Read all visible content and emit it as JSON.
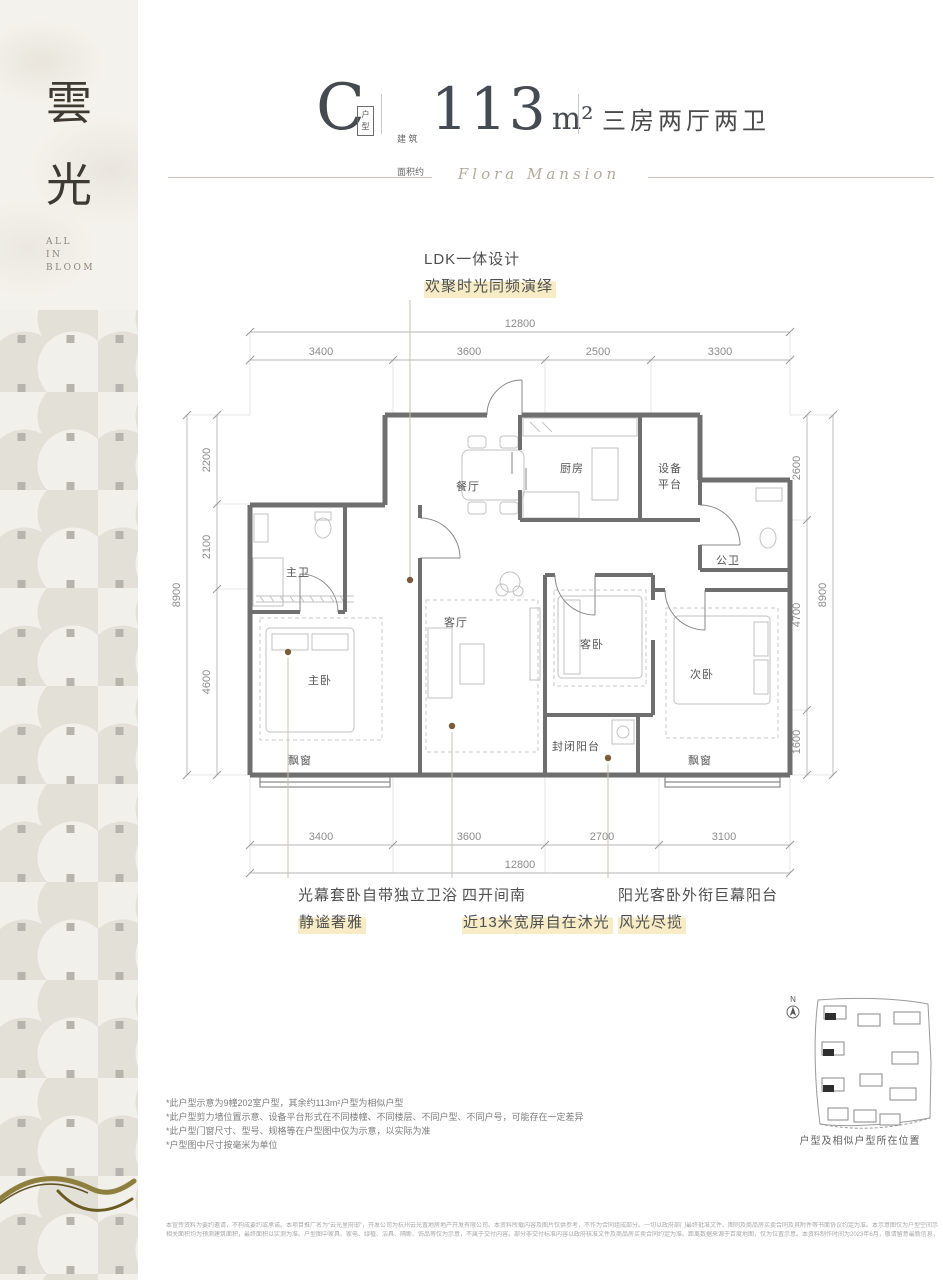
{
  "sidebar": {
    "char1": "雲",
    "char2": "光",
    "tagline1": "ALL",
    "tagline2": "IN",
    "tagline3": "BLOOM"
  },
  "header": {
    "unit_letter": "C",
    "unit_badge": "户型",
    "area_prefix_line1": "建 筑",
    "area_prefix_line2": "面积约",
    "area_value": "113",
    "area_unit": "m²",
    "rooms_label": "三房两厅两卫",
    "script_title": "Flora Mansion"
  },
  "callout_top": {
    "line1": "LDK一体设计",
    "line2": "欢聚时光同频演绎"
  },
  "callouts_bottom": [
    {
      "line1": "光幕套卧自带独立卫浴",
      "line2": "静谧奢雅"
    },
    {
      "line1": "四开间南",
      "line2": "近13米宽屏自在沐光"
    },
    {
      "line1": "阳光客卧外衔巨幕阳台",
      "line2": "风光尽揽"
    }
  ],
  "floorplan": {
    "rooms": {
      "dining": "餐厅",
      "kitchen": "厨房",
      "equip_line1": "设备",
      "equip_line2": "平台",
      "master_bath": "主卫",
      "public_bath": "公卫",
      "master_bed": "主卧",
      "living": "客厅",
      "guest_bed": "客卧",
      "second_bed": "次卧",
      "balcony": "封闭阳台",
      "bay_window": "飘窗"
    },
    "dims": {
      "top_total": "12800",
      "top_s1": "3400",
      "top_s2": "3600",
      "top_s3": "2500",
      "top_s4": "3300",
      "bottom_s1": "3400",
      "bottom_s2": "3600",
      "bottom_s3": "2700",
      "bottom_s4": "3100",
      "bottom_total": "12800",
      "left_total": "8900",
      "left_s1": "2200",
      "left_s2": "2100",
      "left_s3": "4600",
      "right_s1": "2600",
      "right_s2": "4700",
      "right_s3": "1600",
      "right_total": "8900"
    }
  },
  "footnotes": [
    "*此户型示意为9幢202室户型，其余约113m²户型为相似户型",
    "*此户型剪力墙位置示意、设备平台形式在不同楼幢、不同楼层、不同户型、不同户号，可能存在一定差异",
    "*此户型门窗尺寸、型号、规格等在户型图中仅为示意，以实际为准",
    "*户型图中尺寸按毫米为单位"
  ],
  "minimap": {
    "north": "N",
    "caption": "户型及相似户型所在位置"
  },
  "legal": {
    "line1": "本宣传资料为要约邀请，不构成要约或承诺。本项目推广名为“云光里府邸”，开发公司为杭州云光置地房地产开发有限公司。本资料所载内容及图片仅供参考，不作为合同组成部分。一切以政府部门最终批准文件、图则及商品房买卖合同及其附件等书面协议约定为准。本示意图仅为户型空间示意参考，非交付标准，公司保留对宣传资料修改的权利，敬请留意最新资料。本示意图未按比例绘制，仅作直观示意，不作为交付依据。",
    "line2": "相关面积均为预测建筑面积，最终面积以实测为准。户型图中家具、家电、绿植、洁具、隔断、饰品等仅为示意，不属于交付内容。部分非交付标准内容以政府核准文件及商品房买卖合同约定为准。距离数据来源于百度地图，仅为位置示意。本资料制作时间为2023年6月，敬请留意最新信息，图文解释权归开发公司所有。"
  },
  "colors": {
    "highlight": "#f7ecc6",
    "ink": "#454b52",
    "wall": "#6f6f6f",
    "dim": "#8c8c8c",
    "gold": "#8a7a3b"
  }
}
